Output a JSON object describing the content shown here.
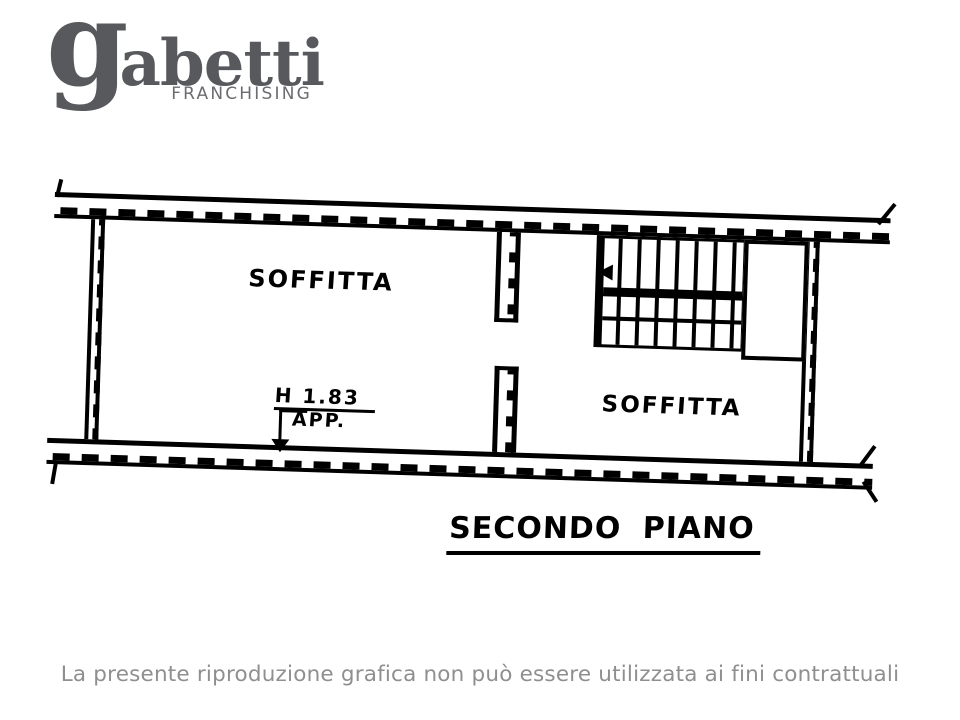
{
  "logo": {
    "brand_g": "g",
    "brand_rest": "abetti",
    "subtitle": "FRANCHISING"
  },
  "plan": {
    "rooms": [
      {
        "label": "SOFFITTA"
      },
      {
        "label": "SOFFITTA"
      }
    ],
    "annotations": {
      "height_label": "H 1.83",
      "apartment_label": "APP."
    },
    "floor_title": "SECONDO PIANO"
  },
  "footer": {
    "disclaimer": "La presente riproduzione grafica non può essere utilizzata ai fini contrattuali"
  },
  "colors": {
    "ink": "#000000",
    "logo_gray": "#58595d",
    "franchising_gray": "#6b6c70",
    "disclaimer_gray": "#8f8f8f",
    "background": "#ffffff"
  }
}
